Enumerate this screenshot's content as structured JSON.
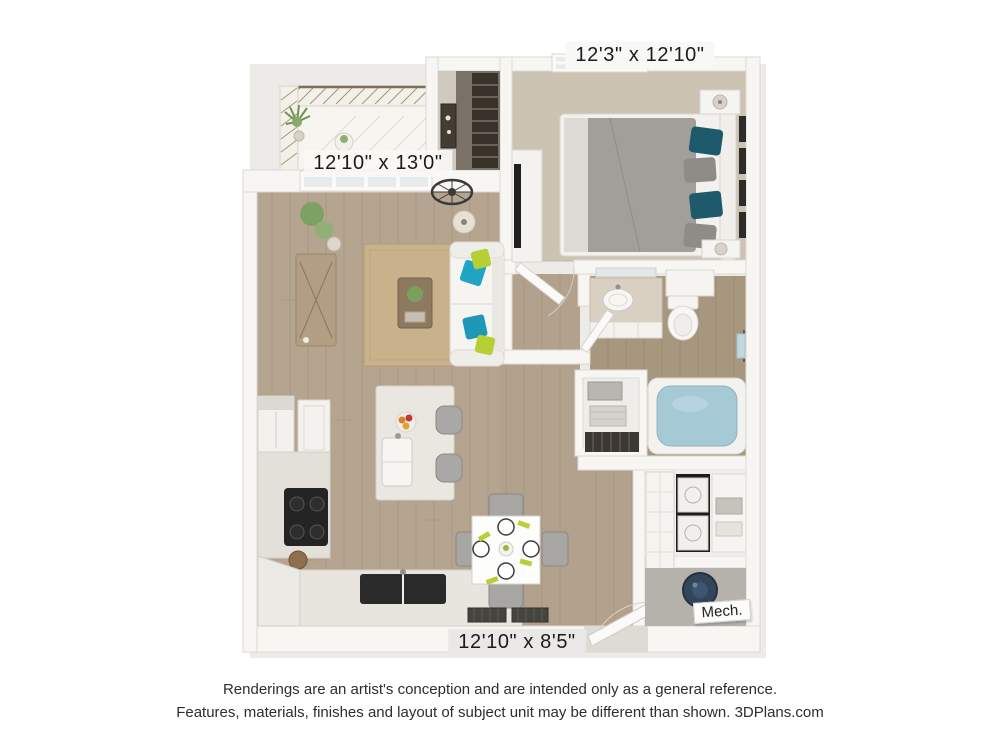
{
  "labels": {
    "bedroom_dim": "12'3\" x 12'10\"",
    "living_dim": "12'10\" x 13'0\"",
    "kitchen_dining_dim": "12'10\" x 8'5\"",
    "mech": "Mech."
  },
  "disclaimer": {
    "line1": "Renderings are an artist's conception and are intended only as a general reference.",
    "line2": "Features, materials, finishes and layout of subject unit may be different than shown. 3DPlans.com"
  },
  "colors": {
    "wall": "#f8f6f3",
    "wood_floor": "#b5a48f",
    "bath_floor": "#a8977f",
    "carpet": "#cdc3b2",
    "rug": "#c9b28b",
    "pillow_teal": "#21a3c4",
    "pillow_lime": "#b6cf35",
    "bed_duvet": "#a29f9b",
    "bed_pillow_teal": "#1e596c",
    "tub_water": "#a6c9d6",
    "water_heater": "#32455a",
    "appliance_dark": "#242424"
  }
}
